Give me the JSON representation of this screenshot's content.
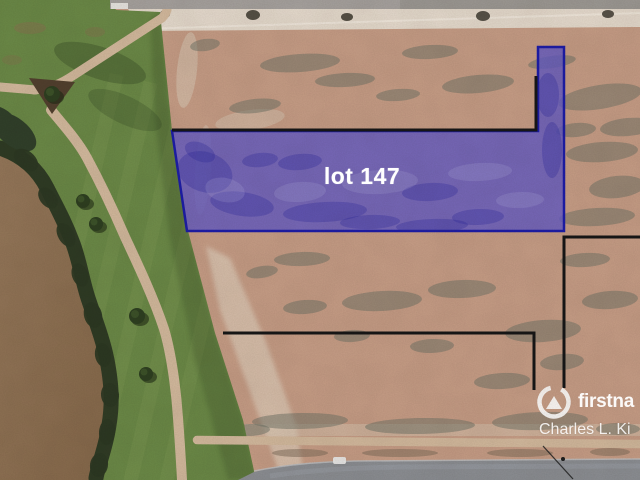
{
  "overlay": {
    "lot_label": "lot 147",
    "fill_color": "#6059c8",
    "border_color": "#1d1caa",
    "boundary_line_color": "#161616"
  },
  "branding": {
    "logo_icon": "first-national-logo-icon",
    "logo_text": "firstna",
    "agent_name": "Charles L. Ki",
    "text_color": "#ffffff"
  },
  "terrain_colors": {
    "dirt": "#c79e87",
    "grass": "#6b8a47",
    "pond_water": "#8f7252",
    "vegetation": "#2f3b24",
    "path": "#d4bb9f",
    "road_top": "#a7a3a0",
    "road_bottom": "#8c8f94",
    "graded_band": "#e6dccf"
  }
}
